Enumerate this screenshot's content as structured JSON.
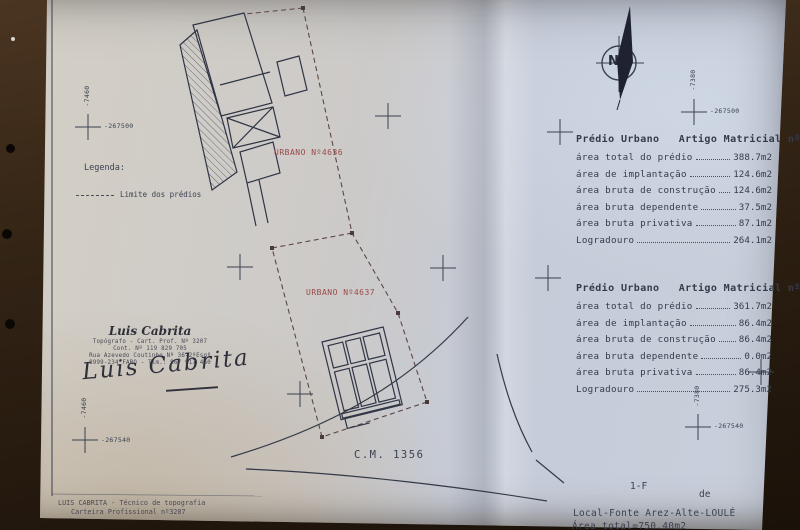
{
  "legend": {
    "title": "Legenda:",
    "item_label": "Limite dos prédios"
  },
  "plan_labels": {
    "parcel_a": "URBANO Nº4636",
    "parcel_b": "URBANO Nº4637",
    "road": "C.M. 1356",
    "north": "N"
  },
  "coord_marks": {
    "top_left_h": "-267500",
    "top_left_v": "-7460",
    "bottom_left_h": "-267540",
    "bottom_left_v": "-7460",
    "top_right_h": "-267500",
    "top_right_v": "-7380",
    "bottom_right_h": "-267540",
    "bottom_right_v": "-7380"
  },
  "stamp": {
    "name": "Luis Cabrita",
    "line1": "Topógrafo - Cart. Prof. Nº 3207",
    "line2": "Cont. Nº 119 829 705",
    "line3": "Rua Azevedo Coutinho Nº 36-2ºEsqº",
    "line4": "8999-234 FARO - Tlm.: 967 917 460",
    "signature": "Luis Cabrita"
  },
  "footer_left": {
    "line1": "LUIS CABRITA - Técnico de topografia",
    "line2": "Carteira Profissional nº3207"
  },
  "tables": [
    {
      "title": "Prédio Urbano   Artigo Matricial nº4636",
      "rows": [
        {
          "label": "área total do prédio",
          "value": "388.7m2"
        },
        {
          "label": "área de implantação",
          "value": "124.6m2"
        },
        {
          "label": "área bruta de construção",
          "value": "124.6m2"
        },
        {
          "label": "área bruta dependente",
          "value": "37.5m2"
        },
        {
          "label": "área bruta privativa",
          "value": "87.1m2"
        },
        {
          "label": "Logradouro",
          "value": "264.1m2"
        }
      ]
    },
    {
      "title": "Prédio Urbano   Artigo Matricial nº4637",
      "rows": [
        {
          "label": "área total do prédio",
          "value": "361.7m2"
        },
        {
          "label": "área de implantação",
          "value": "86.4m2"
        },
        {
          "label": "área bruta de construção",
          "value": "86.4m2"
        },
        {
          "label": "área bruta dependente",
          "value": "0.0m2"
        },
        {
          "label": "área bruta privativa",
          "value": "86.4m2"
        },
        {
          "label": "Logradouro",
          "value": "275.3m2"
        }
      ]
    }
  ],
  "bottom_right": {
    "sheet_ref": "1-F",
    "de_label": "de",
    "local": "Local-Fonte Arez-Alte-LOULÉ",
    "area_total": "Área total=750.40m2"
  },
  "colors": {
    "ink": "#3a4150",
    "red_label": "#9c4848",
    "paper": "#cbccd2",
    "background": "#2b1d12"
  }
}
